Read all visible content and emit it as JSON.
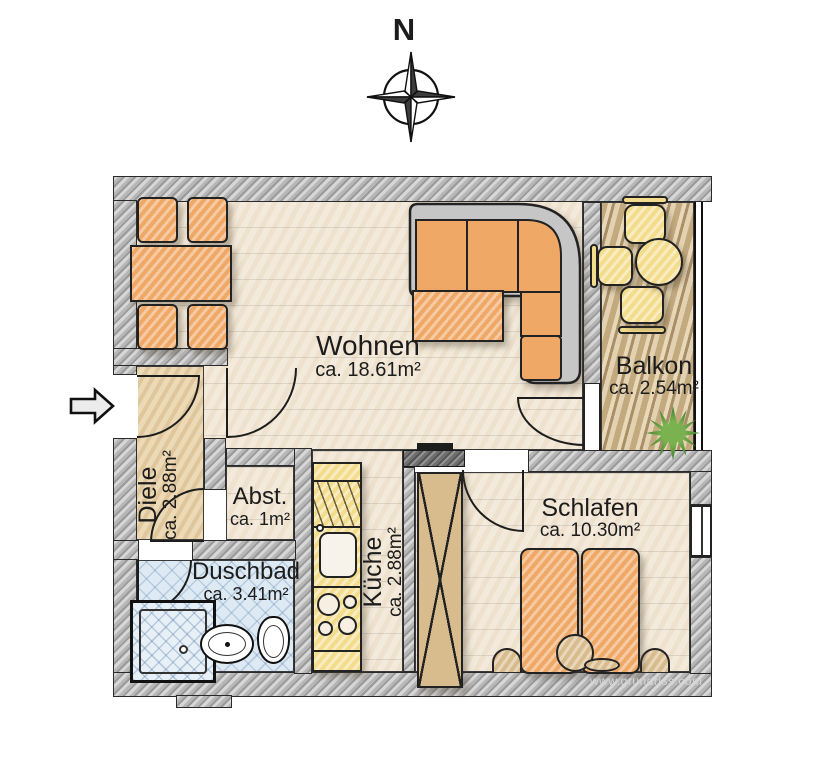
{
  "title": "Apartment floor plan",
  "compass": {
    "label": "N"
  },
  "watermark": "www.grundriss.com",
  "rooms": {
    "wohnen": {
      "name": "Wohnen",
      "area": "ca. 18.61m²"
    },
    "balkon": {
      "name": "Balkon",
      "area": "ca. 2.54m²"
    },
    "diele": {
      "name": "Diele",
      "area": "ca. 2.88m²"
    },
    "abstellraum": {
      "name": "Abst.",
      "area": "ca. 1m²"
    },
    "duschbad": {
      "name": "Duschbad",
      "area": "ca. 3.41m²"
    },
    "kueche": {
      "name": "Küche",
      "area": "ca. 2.88m²"
    },
    "schlafen": {
      "name": "Schlafen",
      "area": "ca. 10.30m²"
    }
  },
  "colors": {
    "wall": "#b7b7b7",
    "floor": "#f3eadb",
    "furniture_orange": "#f0a867",
    "balcony_wood": "#d9c49c",
    "bath_blue": "#dde9f3",
    "kitchen_yellow": "#f3dd8d",
    "plant_green": "#4e9a3c"
  }
}
